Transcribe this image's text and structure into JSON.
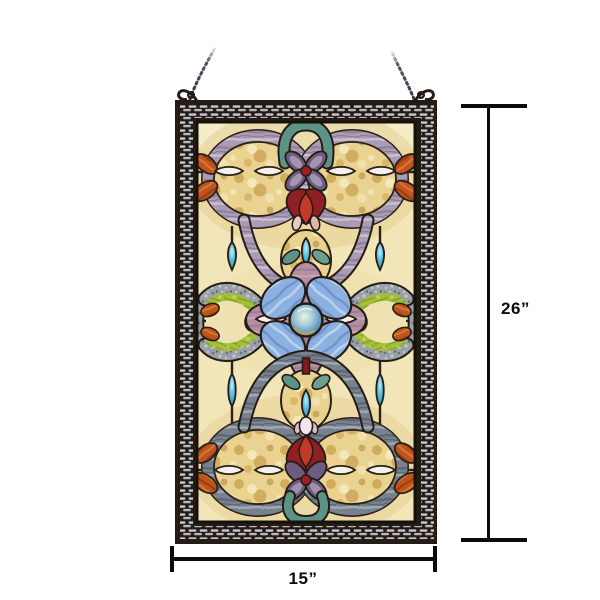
{
  "annotations": {
    "height_label": "26”",
    "width_label": "15”"
  },
  "palette": {
    "frame": "#241c15",
    "mesh_light": "#c8cbd1",
    "glass_cream": "#f2e6b8",
    "glass_amber": "#ead391",
    "band_lavender": "#aa9cb2",
    "band_slate": "#78828e",
    "leaf_lime": "#a4be3c",
    "leaf_teal": "#5b9486",
    "petal_blue": "#8cb1e0",
    "petal_mauve": "#b48fa3",
    "petal_purple": "#6e5c80",
    "tulip_red": "#8e2025",
    "tulip_red_bright": "#c23a2a",
    "accent_orange": "#bf541f",
    "jewel_cyan": "#49b4dc",
    "dimension_line": "#0b0b0b",
    "chain": "#34344c"
  }
}
